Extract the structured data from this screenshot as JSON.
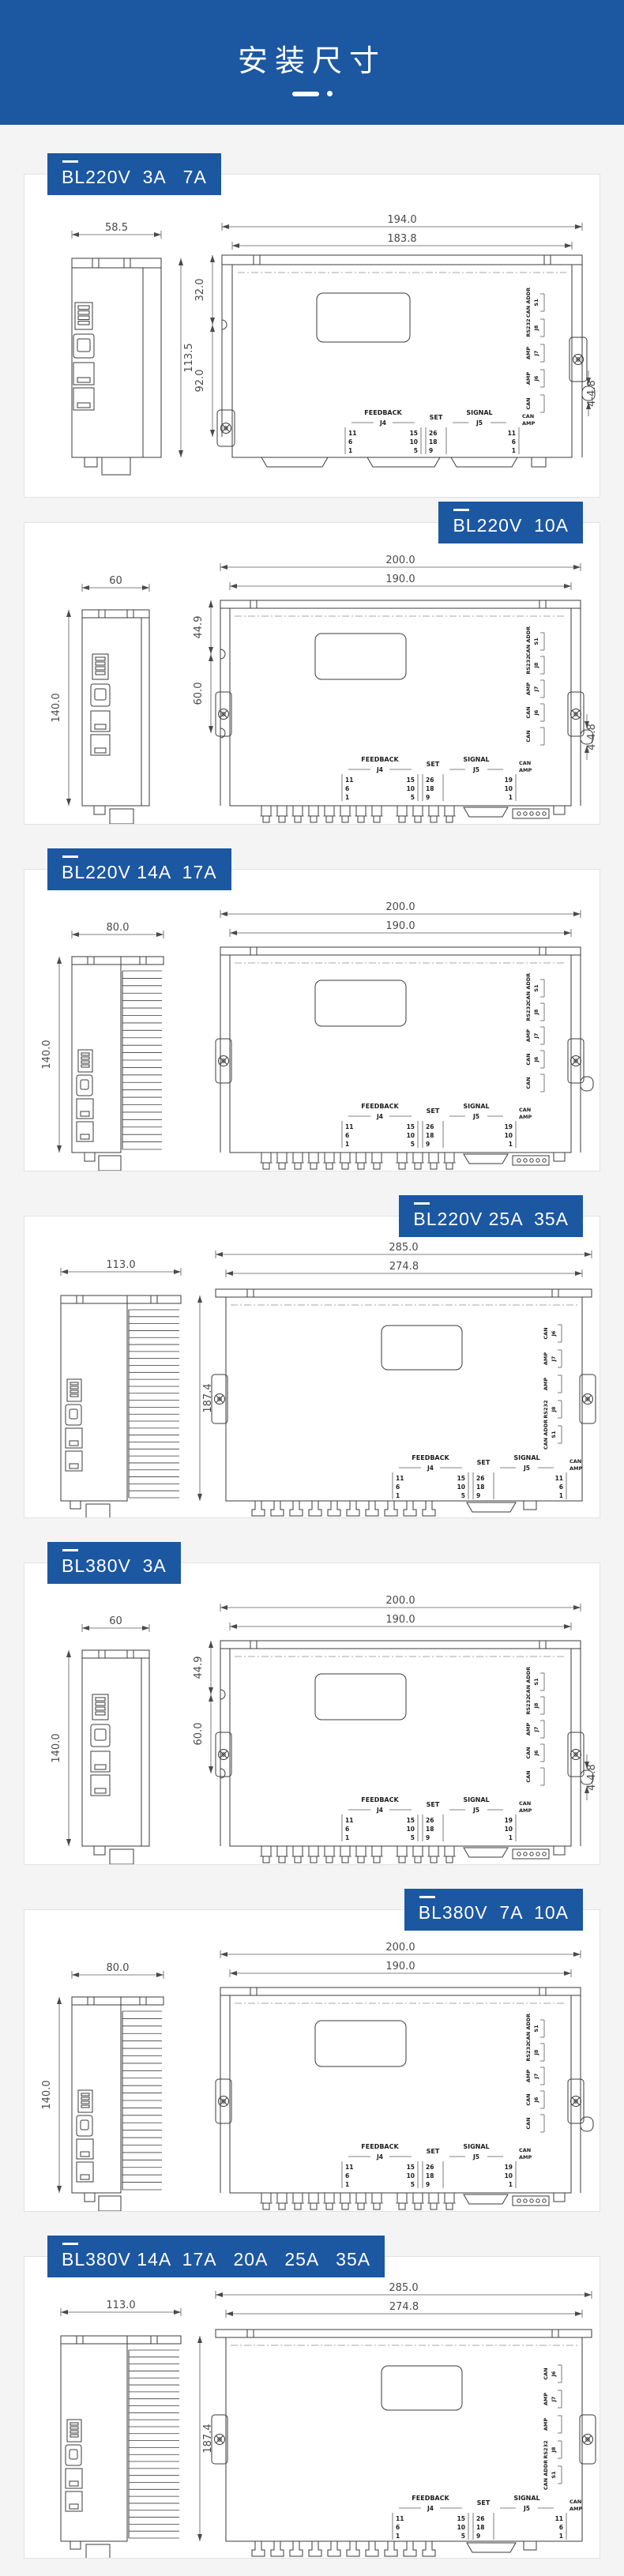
{
  "page": {
    "header": {
      "title": "安装尺寸"
    },
    "colors": {
      "accent": "#1c57a2",
      "page_bg": "#f4f4f5",
      "card_bg": "#ffffff",
      "line": "#3b3b3b"
    }
  },
  "sections": [
    {
      "label": "BL220V  3A   7A",
      "side": "left",
      "variant": "A",
      "dims": {
        "side_w": "58.5",
        "side_h": "113.5",
        "front_w": "194.0",
        "front_w2": "183.8",
        "v1": "32.0",
        "v2": "92.0",
        "holes": "4-4.8"
      },
      "pins": {
        "feedback": "FEEDBACK",
        "j4": "J4",
        "j4_left": [
          "11",
          "6",
          "1"
        ],
        "j4_right": [
          "15",
          "10",
          "5"
        ],
        "set": "SET",
        "set_pins": [
          "26",
          "18",
          "9"
        ],
        "signal": "SIGNAL",
        "j5": "J5",
        "j5_pins": [
          "11",
          "6",
          "1"
        ],
        "can": "CAN",
        "amp": "AMP"
      },
      "side_labels": [
        {
          "a": "CAN ADDR",
          "b": "S1"
        },
        {
          "a": "RS232",
          "b": "J8"
        },
        {
          "a": "AMP",
          "b": "J7"
        },
        {
          "a": "AMP",
          "b": "J6"
        },
        {
          "a": "CAN",
          "b": ""
        }
      ]
    },
    {
      "label": "BL220V  10A",
      "side": "right",
      "variant": "B",
      "dims": {
        "side_w": "60",
        "side_h": "140.0",
        "front_w": "200.0",
        "front_w2": "190.0",
        "v1": "44.9",
        "v2": "60.0",
        "holes": "4-4.8"
      },
      "pins": {
        "feedback": "FEEDBACK",
        "j4": "J4",
        "j4_left": [
          "11",
          "6",
          "1"
        ],
        "j4_right": [
          "15",
          "10",
          "5"
        ],
        "set": "SET",
        "set_pins": [
          "26",
          "18",
          "9"
        ],
        "signal": "SIGNAL",
        "j5": "J5",
        "j5_pins": [
          "19",
          "10",
          "1"
        ],
        "can": "CAN",
        "amp": "AMP"
      },
      "side_labels": [
        {
          "a": "CAN ADDR",
          "b": "S1"
        },
        {
          "a": "RS232",
          "b": "J8"
        },
        {
          "a": "AMP",
          "b": "J7"
        },
        {
          "a": "CAN",
          "b": "J6"
        },
        {
          "a": "CAN",
          "b": ""
        }
      ]
    },
    {
      "label": "BL220V 14A  17A",
      "side": "left",
      "variant": "C",
      "dims": {
        "side_w": "80.0",
        "side_h": "140.0",
        "front_w": "200.0",
        "front_w2": "190.0"
      },
      "pins": {
        "feedback": "FEEDBACK",
        "j4": "J4",
        "j4_left": [
          "11",
          "6",
          "1"
        ],
        "j4_right": [
          "15",
          "10",
          "5"
        ],
        "set": "SET",
        "set_pins": [
          "26",
          "18",
          "9"
        ],
        "signal": "SIGNAL",
        "j5": "J5",
        "j5_pins": [
          "19",
          "10",
          "1"
        ],
        "can": "CAN",
        "amp": "AMP"
      },
      "side_labels": [
        {
          "a": "CAN ADDR",
          "b": "S1"
        },
        {
          "a": "RS232",
          "b": "J8"
        },
        {
          "a": "AMP",
          "b": "J7"
        },
        {
          "a": "CAN",
          "b": "J6"
        },
        {
          "a": "CAN",
          "b": ""
        }
      ]
    },
    {
      "label": "BL220V 25A  35A",
      "side": "right",
      "variant": "D",
      "dims": {
        "side_w": "113.0",
        "side_h": "187.4",
        "front_w": "285.0",
        "front_w2": "274.8"
      },
      "pins": {
        "feedback": "FEEDBACK",
        "j4": "J4",
        "j4_left": [
          "11",
          "6",
          "1"
        ],
        "j4_right": [
          "15",
          "10",
          "5"
        ],
        "set": "SET",
        "set_pins": [
          "26",
          "18",
          "9"
        ],
        "signal": "SIGNAL",
        "j5": "J5",
        "j5_pins": [
          "11",
          "6",
          "1"
        ],
        "can": "CAN",
        "amp": "AMP"
      },
      "side_labels": [
        {
          "a": "CAN",
          "b": "J6"
        },
        {
          "a": "AMP",
          "b": "J7"
        },
        {
          "a": "AMP",
          "b": ""
        },
        {
          "a": "RS232",
          "b": "J8"
        },
        {
          "a": "CAN ADDR",
          "b": "S1"
        }
      ]
    },
    {
      "label": "BL380V  3A",
      "side": "left",
      "variant": "B",
      "dims": {
        "side_w": "60",
        "side_h": "140.0",
        "front_w": "200.0",
        "front_w2": "190.0",
        "v1": "44.9",
        "v2": "60.0",
        "holes": "4-4.8"
      },
      "pins": {
        "feedback": "FEEDBACK",
        "j4": "J4",
        "j4_left": [
          "11",
          "6",
          "1"
        ],
        "j4_right": [
          "15",
          "10",
          "5"
        ],
        "set": "SET",
        "set_pins": [
          "26",
          "18",
          "9"
        ],
        "signal": "SIGNAL",
        "j5": "J5",
        "j5_pins": [
          "19",
          "10",
          "1"
        ],
        "can": "CAN",
        "amp": "AMP"
      },
      "side_labels": [
        {
          "a": "CAN ADDR",
          "b": "S1"
        },
        {
          "a": "RS232",
          "b": "J8"
        },
        {
          "a": "AMP",
          "b": "J7"
        },
        {
          "a": "CAN",
          "b": "J6"
        },
        {
          "a": "CAN",
          "b": ""
        }
      ]
    },
    {
      "label": "BL380V  7A  10A",
      "side": "right",
      "variant": "C",
      "dims": {
        "side_w": "80.0",
        "side_h": "140.0",
        "front_w": "200.0",
        "front_w2": "190.0"
      },
      "pins": {
        "feedback": "FEEDBACK",
        "j4": "J4",
        "j4_left": [
          "11",
          "6",
          "1"
        ],
        "j4_right": [
          "15",
          "10",
          "5"
        ],
        "set": "SET",
        "set_pins": [
          "26",
          "18",
          "9"
        ],
        "signal": "SIGNAL",
        "j5": "J5",
        "j5_pins": [
          "19",
          "10",
          "1"
        ],
        "can": "CAN",
        "amp": "AMP"
      },
      "side_labels": [
        {
          "a": "CAN ADDR",
          "b": "S1"
        },
        {
          "a": "RS232",
          "b": "J8"
        },
        {
          "a": "AMP",
          "b": "J7"
        },
        {
          "a": "CAN",
          "b": "J6"
        },
        {
          "a": "CAN",
          "b": ""
        }
      ]
    },
    {
      "label": "BL380V 14A  17A   20A   25A   35A",
      "side": "left",
      "variant": "D",
      "dims": {
        "side_w": "113.0",
        "side_h": "187.4",
        "front_w": "285.0",
        "front_w2": "274.8"
      },
      "pins": {
        "feedback": "FEEDBACK",
        "j4": "J4",
        "j4_left": [
          "11",
          "6",
          "1"
        ],
        "j4_right": [
          "15",
          "10",
          "5"
        ],
        "set": "SET",
        "set_pins": [
          "26",
          "18",
          "9"
        ],
        "signal": "SIGNAL",
        "j5": "J5",
        "j5_pins": [
          "11",
          "6",
          "1"
        ],
        "can": "CAN",
        "amp": "AMP"
      },
      "side_labels": [
        {
          "a": "CAN",
          "b": "J6"
        },
        {
          "a": "AMP",
          "b": "J7"
        },
        {
          "a": "AMP",
          "b": ""
        },
        {
          "a": "RS232",
          "b": "J8"
        },
        {
          "a": "CAN ADDR",
          "b": "S1"
        }
      ]
    }
  ]
}
